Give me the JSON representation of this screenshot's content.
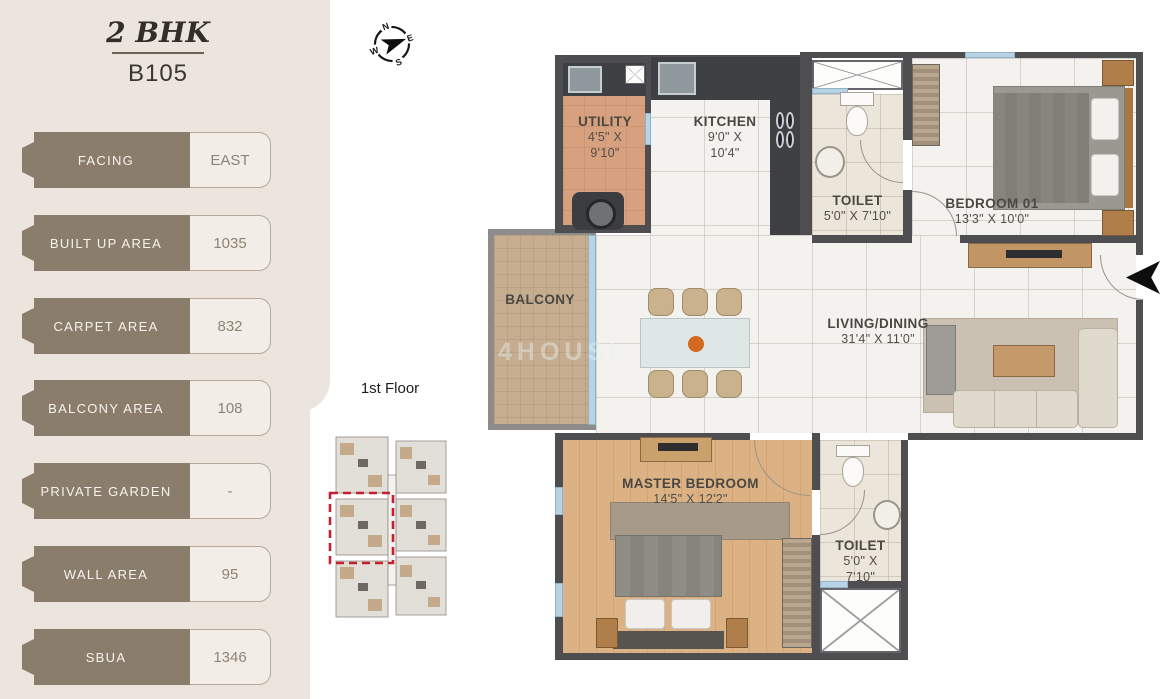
{
  "header": {
    "bhk": "2 BHK",
    "unit": "B105"
  },
  "sidebar": {
    "specs": [
      {
        "label": "FACING",
        "value": "EAST"
      },
      {
        "label": "BUILT UP AREA",
        "value": "1035"
      },
      {
        "label": "CARPET AREA",
        "value": "832"
      },
      {
        "label": "BALCONY AREA",
        "value": "108"
      },
      {
        "label": "PRIVATE GARDEN",
        "value": "-"
      },
      {
        "label": "WALL AREA",
        "value": "95"
      },
      {
        "label": "SBUA",
        "value": "1346"
      }
    ]
  },
  "floor_plate": {
    "label": "1st Floor"
  },
  "compass": {
    "n": "N",
    "e": "E",
    "s": "S",
    "w": "W"
  },
  "watermark": "4HOUSI",
  "rooms": {
    "utility": {
      "name": "UTILITY",
      "dims1": "4'5\" X",
      "dims2": "9'10\""
    },
    "kitchen": {
      "name": "KITCHEN",
      "dims1": "9'0\" X",
      "dims2": "10'4\""
    },
    "toilet1": {
      "name": "TOILET",
      "dims1": "5'0\" X 7'10\""
    },
    "bedroom01": {
      "name": "BEDROOM 01",
      "dims1": "13'3\" X 10'0\""
    },
    "balcony": {
      "name": "BALCONY"
    },
    "living": {
      "name": "LIVING/DINING",
      "dims1": "31'4\" X 11'0\""
    },
    "master": {
      "name": "MASTER BEDROOM",
      "dims1": "14'5\" X 12'2\""
    },
    "toilet2": {
      "name": "TOILET",
      "dims1": "5'0\" X",
      "dims2": "7'10\""
    }
  },
  "colors": {
    "accent": "#8b7d6b",
    "highlight_red": "#c5202f",
    "wall": "#4e4d4f",
    "window_blue": "#b7d3e4"
  }
}
